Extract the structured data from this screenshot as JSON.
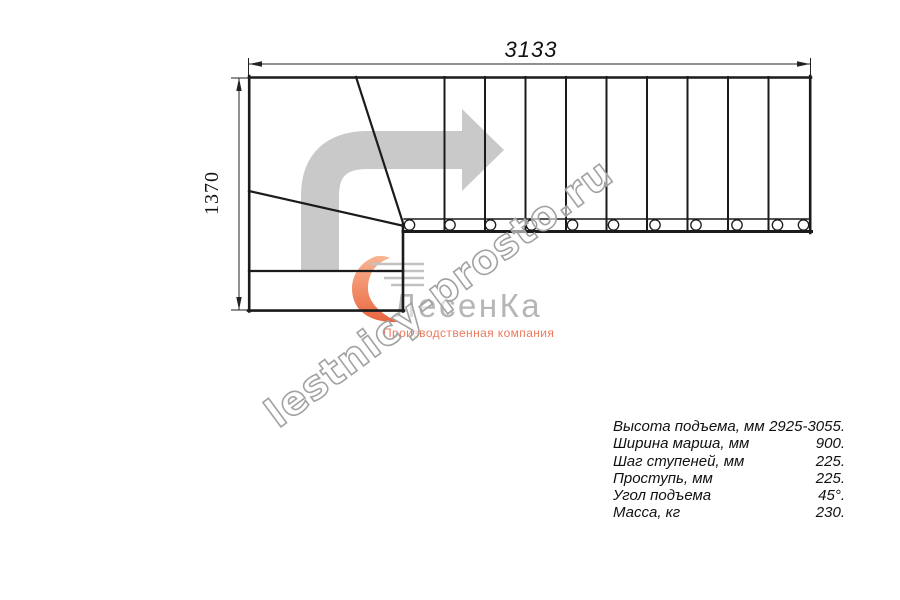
{
  "dimensions": {
    "top_width_mm": "3133",
    "left_depth_mm": "1370"
  },
  "watermark": {
    "text": "lestnicy-prosto.ru"
  },
  "logo": {
    "brand": "ЛесенКа",
    "subtitle": "Производственная компания"
  },
  "specs": {
    "rows": [
      {
        "label": "Высота подъема, мм",
        "value": "2925-3055."
      },
      {
        "label": "Ширина марша, мм",
        "value": "900."
      },
      {
        "label": "Шаг ступеней, мм",
        "value": "225."
      },
      {
        "label": "Проступь, мм",
        "value": "225."
      },
      {
        "label": "Угол подъема",
        "value": "45°."
      },
      {
        "label": "Масса, кг",
        "value": "230."
      }
    ]
  },
  "drawing": {
    "type": "staircase-plan-top-view",
    "straight_treads": 10,
    "winder_treads": 3,
    "balusters": 11,
    "direction": "up-then-turn-right-90"
  },
  "colors": {
    "plan_line": "#1b1b1b",
    "arrow_gray": "#c9c9c9",
    "watermark_gray": "#a2a2a2",
    "logo_text_gray": "#b6b6b6",
    "logo_orange": "#ec7a5e"
  }
}
